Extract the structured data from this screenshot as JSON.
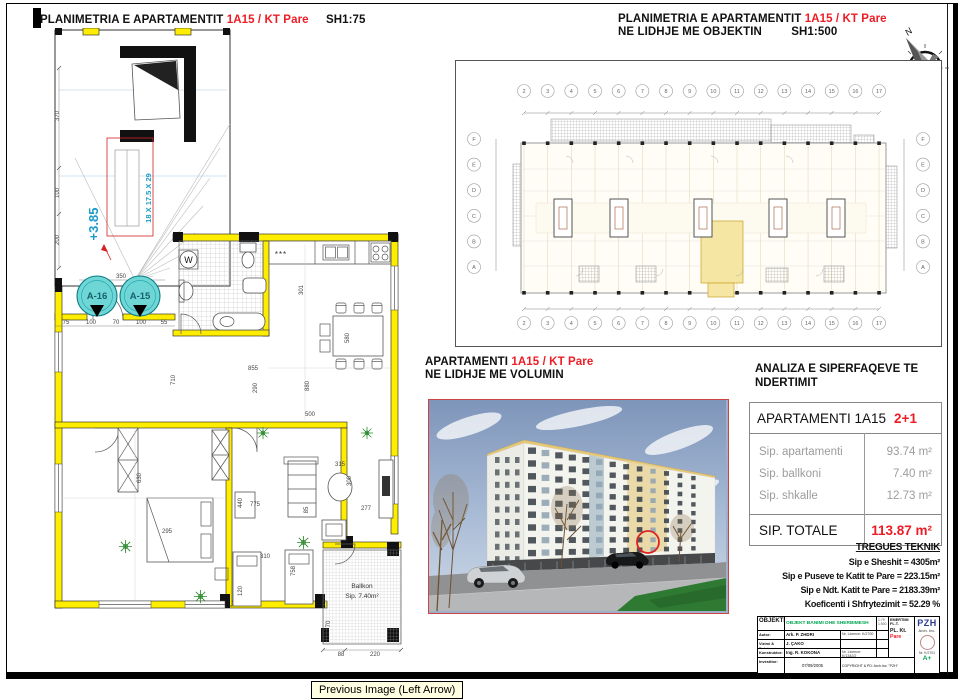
{
  "frame": {
    "tooltip": "Previous Image (Left Arrow)"
  },
  "left_plan": {
    "title": "PLANIMETRIA E APARTAMENTIT",
    "title_accent": "1A15 / KT Pare",
    "scale": "SH1:75",
    "level": "+3.85",
    "stair_spec": "18 X 17.5 X 29",
    "axis_a16": "A-16",
    "axis_a15": "A-15",
    "washer": "W",
    "kitchen_unit": "***",
    "balcony_name": "Ballkon",
    "balcony_area": "Sip. 7.40m²",
    "dims": [
      {
        "t": "370",
        "x": 24,
        "y": 88,
        "r": -90
      },
      {
        "t": "100",
        "x": 24,
        "y": 165,
        "r": -90
      },
      {
        "t": "200",
        "x": 24,
        "y": 212,
        "r": -90
      },
      {
        "t": "350",
        "x": 86,
        "y": 250
      },
      {
        "t": "230",
        "x": 80,
        "y": 272,
        "r": -90
      },
      {
        "t": "75",
        "x": 31,
        "y": 296
      },
      {
        "t": "100",
        "x": 56,
        "y": 296
      },
      {
        "t": "70",
        "x": 81,
        "y": 296
      },
      {
        "t": "100",
        "x": 106,
        "y": 296
      },
      {
        "t": "55",
        "x": 129,
        "y": 296
      },
      {
        "t": "301",
        "x": 268,
        "y": 262,
        "r": -90
      },
      {
        "t": "855",
        "x": 218,
        "y": 342
      },
      {
        "t": "710",
        "x": 140,
        "y": 352,
        "r": -90
      },
      {
        "t": "290",
        "x": 222,
        "y": 360,
        "r": -90
      },
      {
        "t": "880",
        "x": 274,
        "y": 358,
        "r": -90
      },
      {
        "t": "500",
        "x": 275,
        "y": 388
      },
      {
        "t": "580",
        "x": 314,
        "y": 310,
        "r": -90
      },
      {
        "t": "630",
        "x": 106,
        "y": 450,
        "r": -90
      },
      {
        "t": "295",
        "x": 132,
        "y": 505
      },
      {
        "t": "440",
        "x": 207,
        "y": 475,
        "r": -90
      },
      {
        "t": "775",
        "x": 220,
        "y": 478
      },
      {
        "t": "315",
        "x": 305,
        "y": 438
      },
      {
        "t": "300",
        "x": 316,
        "y": 453,
        "r": -90
      },
      {
        "t": "85",
        "x": 273,
        "y": 482,
        "r": -90
      },
      {
        "t": "277",
        "x": 331,
        "y": 482
      },
      {
        "t": "310",
        "x": 230,
        "y": 530
      },
      {
        "t": "120",
        "x": 207,
        "y": 563,
        "r": -90
      },
      {
        "t": "758",
        "x": 260,
        "y": 543,
        "r": -90
      },
      {
        "t": "70",
        "x": 295,
        "y": 596,
        "r": -90
      },
      {
        "t": "88",
        "x": 306,
        "y": 628
      },
      {
        "t": "220",
        "x": 340,
        "y": 628
      }
    ]
  },
  "right_plan": {
    "title": "PLANIMETRIA E APARTAMENTIT",
    "title_accent": "1A15 / KT Pare",
    "subtitle": "NE LIDHJE ME OBJEKTIN",
    "scale": "SH1:500",
    "north": "N",
    "grid_cols": [
      "2",
      "3",
      "4",
      "5",
      "6",
      "7",
      "8",
      "9",
      "10",
      "11",
      "12",
      "13",
      "14",
      "15",
      "16",
      "17"
    ],
    "grid_rows": [
      "F",
      "E",
      "D",
      "C",
      "B",
      "A"
    ]
  },
  "volume": {
    "title": "APARTAMENTI",
    "title_accent": "1A15 / KT Pare",
    "subtitle": "NE LIDHJE ME VOLUMIN"
  },
  "analysis": {
    "heading_line1": "ANALIZA E SIPERFAQEVE TE",
    "heading_line2": "NDERTIMIT",
    "apartment_label": "APARTAMENTI 1A15",
    "apartment_type": "2+1",
    "rows": [
      {
        "label": "Sip. apartamenti",
        "value": "93.74 m²"
      },
      {
        "label": "Sip. ballkoni",
        "value": "7.40 m²"
      },
      {
        "label": "Sip. shkalle",
        "value": "12.73 m²"
      }
    ],
    "total_label": "SIP. TOTALE",
    "total_value": "113.87 m²"
  },
  "tregues": {
    "heading": "TREGUES TEKNIK",
    "lines": [
      "Sip e Sheshit = 4305m²",
      "Sip e Puseve te Katit te Pare = 223.15m²",
      "Sip e Ndt. Katit te Pare = 2183.39m²",
      "Koeficenti i Shfrytezimit = 52.29 %"
    ]
  },
  "titleblock": {
    "objekti_label": "OBJEKTI:",
    "objekti_value": "OBJEKT BANIMI DHE SHERBIMESH",
    "scale_line1": "1:75",
    "scale_line2": "1:500",
    "emertimi_label": "EMERTIMI FL.T.",
    "emertimi_value": "PL. Kt.",
    "emertimi_accent": "Pare",
    "logo": "PZH",
    "logo_sub": "Arch. Inc.",
    "logo_nr": "Nr. K/2701",
    "logo_mark": "A+",
    "rows": [
      {
        "label": "Autor:",
        "value": "Ark. P. ZHDRI",
        "extra": "Nr. Licence: K/2700"
      },
      {
        "label": "Vizimi & Detaje:",
        "value": "J. ÇAKO",
        "extra": ""
      },
      {
        "label": "Konstruktor:",
        "value": "Ing. R. KOKONA",
        "extra": "Nr. Licence: K/1342/2"
      }
    ],
    "investitor_label": "Investitor:",
    "date": "07/09/2005",
    "copyright": "COPYRIGHT & PD: Arch.Inc. \"PZH\""
  }
}
